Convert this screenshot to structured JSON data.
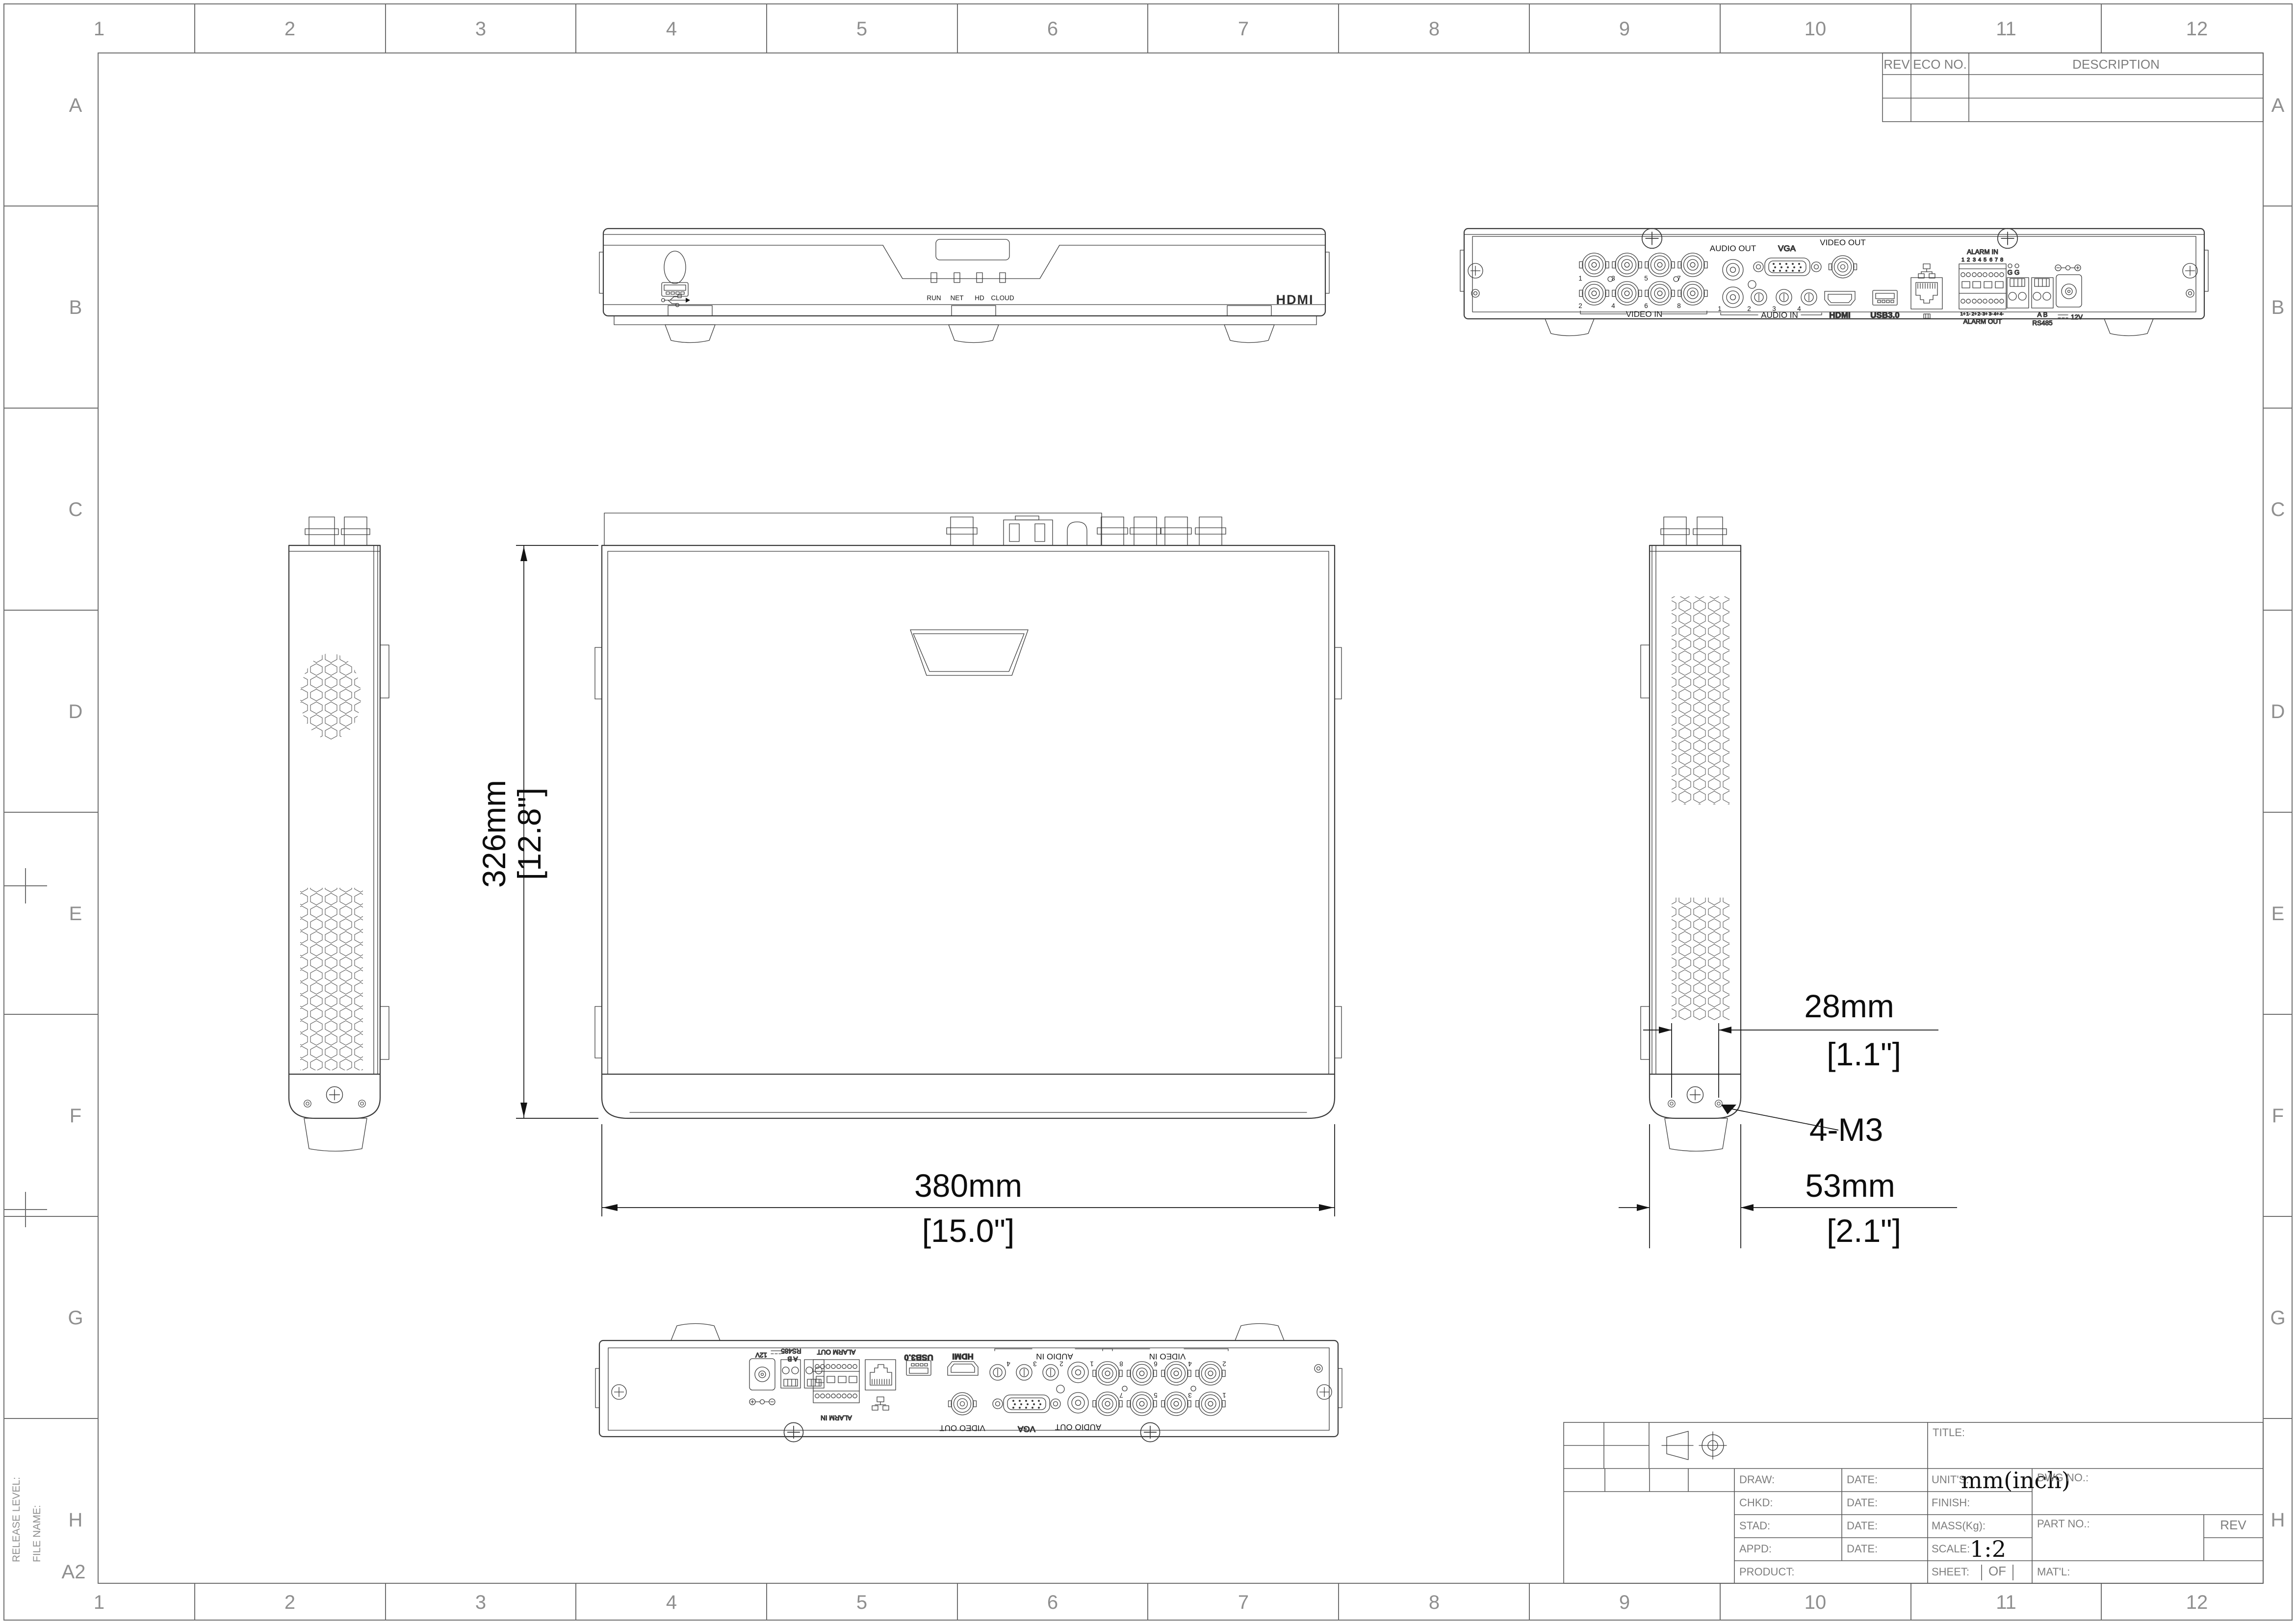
{
  "sheet": {
    "size": "A2",
    "columns": [
      "1",
      "2",
      "3",
      "4",
      "5",
      "6",
      "7",
      "8",
      "9",
      "10",
      "11",
      "12"
    ],
    "rows": [
      "A",
      "B",
      "C",
      "D",
      "E",
      "F",
      "G",
      "H"
    ],
    "release_level_label": "RELEASE LEVEL:",
    "file_name_label": "FILE NAME:"
  },
  "revision_table": {
    "rev": "REV",
    "eco": "ECO NO.",
    "description": "DESCRIPTION"
  },
  "title_block": {
    "title": "TITLE:",
    "draw": "DRAW:",
    "chkd": "CHKD:",
    "stad": "STAD:",
    "appd": "APPD:",
    "product": "PRODUCT:",
    "date": "DATE:",
    "units": "UNIT'S:",
    "units_value": "mm(inch)",
    "finish": "FINISH:",
    "mass": "MASS(Kg):",
    "scale": "SCALE:",
    "scale_value": "1:2",
    "dwg": "DWG NO.:",
    "part": "PART NO.:",
    "rev": "REV",
    "sheet": "SHEET:",
    "of": "OF",
    "matl": "MAT'L:"
  },
  "front_view": {
    "led_labels": [
      "RUN",
      "NET",
      "HD",
      "CLOUD"
    ],
    "hdmi_logo": "HDMI"
  },
  "rear_view": {
    "video_in": "VIDEO IN",
    "video_in_top_numbers": [
      "1",
      "3",
      "5",
      "7"
    ],
    "video_in_bottom_numbers": [
      "2",
      "4",
      "6",
      "8"
    ],
    "audio_out": "AUDIO OUT",
    "audio_in": "AUDIO IN",
    "audio_in_numbers": [
      "1",
      "2",
      "3",
      "4"
    ],
    "vga": "VGA",
    "video_out": "VIDEO OUT",
    "hdmi": "HDMI",
    "usb": "USB3.0",
    "alarm_in": "ALARM IN",
    "alarm_in_pins": [
      "1",
      "2",
      "3",
      "4",
      "5",
      "6",
      "7",
      "8"
    ],
    "alarm_out": "ALARM OUT",
    "alarm_out_pins": [
      "1+",
      "1-",
      "2+",
      "2-",
      "3+",
      "3-",
      "4+",
      "4-"
    ],
    "ground": "G G",
    "ab": "A B",
    "rs485": "RS485",
    "power": "12V"
  },
  "dims": {
    "height_mm": "326mm",
    "height_inch": "[12.8\"]",
    "width_mm": "380mm",
    "width_inch": "[15.0\"]",
    "spacing_mm": "28mm",
    "spacing_inch": "[1.1\"]",
    "depth_mm": "53mm",
    "depth_inch": "[2.1\"]",
    "thread": "4-M3"
  }
}
